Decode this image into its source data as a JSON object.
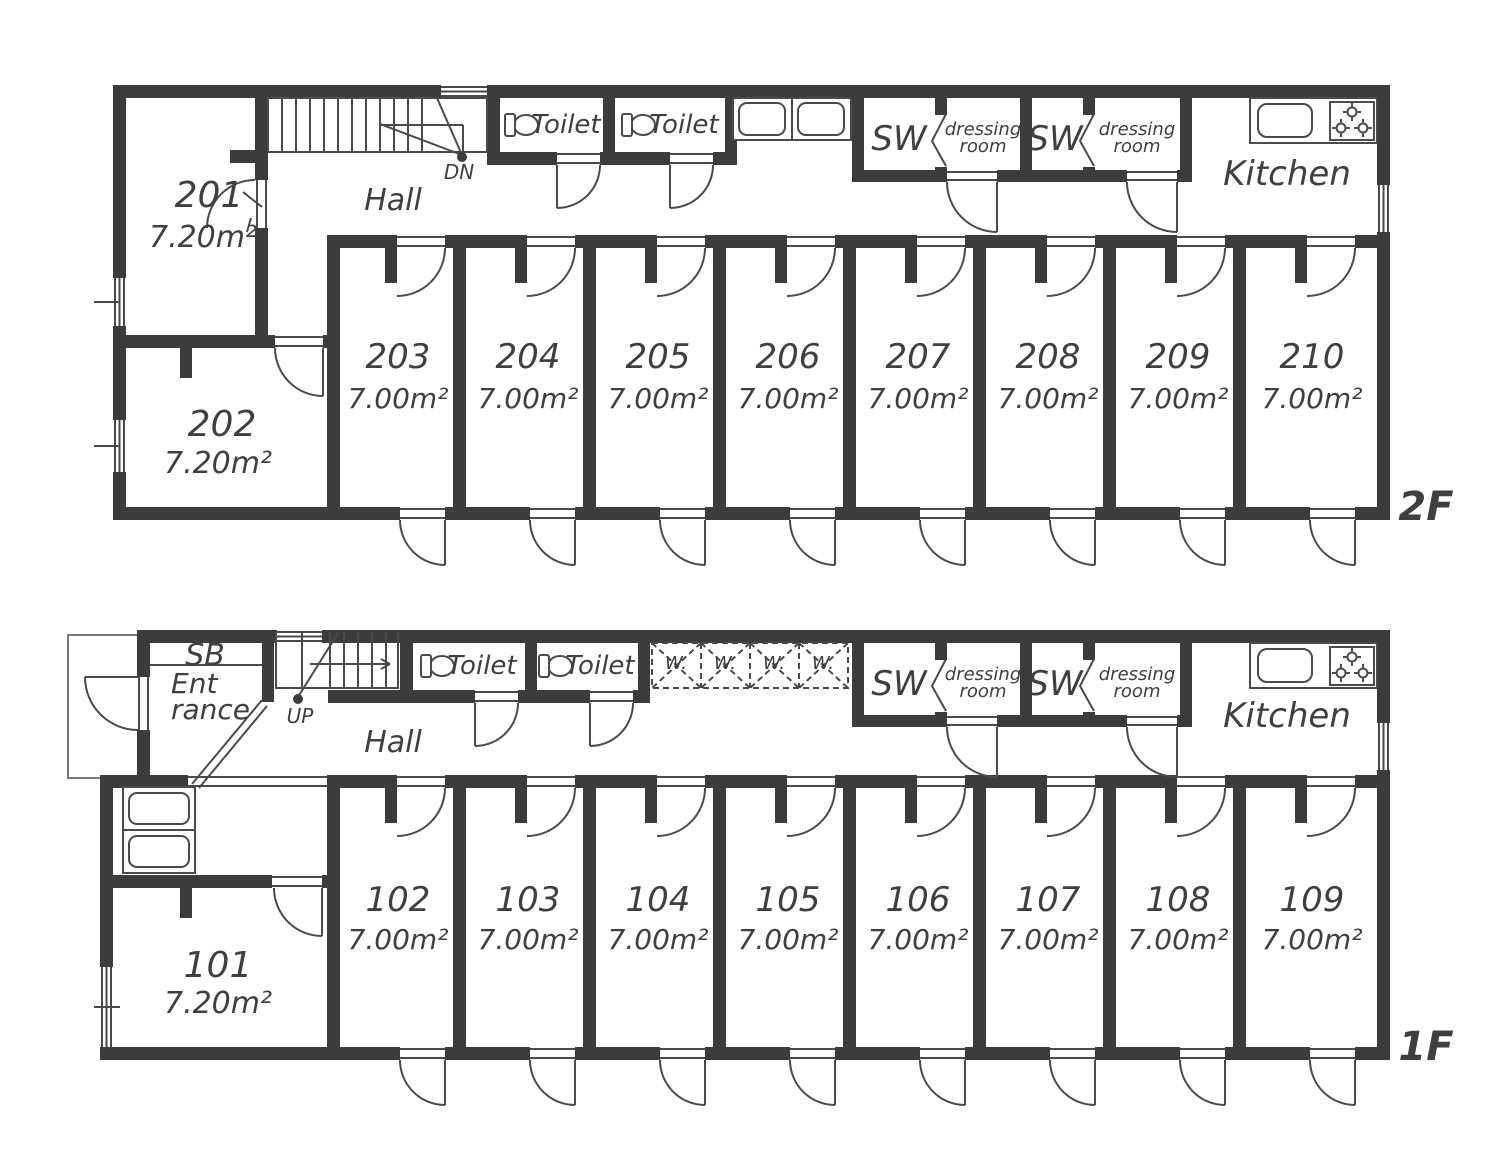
{
  "colors": {
    "wall": "#3c3c3c",
    "line": "#4a4a4a",
    "text": "#3f3f3f"
  },
  "floors": [
    {
      "name": "2F",
      "stair_label": "DN",
      "hall_label": "Hall",
      "toilet_label": "Toilet",
      "sw_label": "SW",
      "dressing_label_line1": "dressing",
      "dressing_label_line2": "room",
      "kitchen_label": "Kitchen",
      "corner_rooms": [
        {
          "number": "201",
          "area": "7.20m²"
        },
        {
          "number": "202",
          "area": "7.20m²"
        }
      ],
      "rooms": [
        {
          "number": "203",
          "area": "7.00m²"
        },
        {
          "number": "204",
          "area": "7.00m²"
        },
        {
          "number": "205",
          "area": "7.00m²"
        },
        {
          "number": "206",
          "area": "7.00m²"
        },
        {
          "number": "207",
          "area": "7.00m²"
        },
        {
          "number": "208",
          "area": "7.00m²"
        },
        {
          "number": "209",
          "area": "7.00m²"
        },
        {
          "number": "210",
          "area": "7.00m²"
        }
      ]
    },
    {
      "name": "1F",
      "stair_label": "UP",
      "hall_label": "Hall",
      "toilet_label": "Toilet",
      "sw_label": "SW",
      "dressing_label_line1": "dressing",
      "dressing_label_line2": "room",
      "kitchen_label": "Kitchen",
      "shoebox_label": "SB",
      "entrance_label_line1": "Ent",
      "entrance_label_line2": "rance",
      "washer_label": "W.",
      "corner_rooms": [
        {
          "number": "101",
          "area": "7.20m²"
        }
      ],
      "rooms": [
        {
          "number": "102",
          "area": "7.00m²"
        },
        {
          "number": "103",
          "area": "7.00m²"
        },
        {
          "number": "104",
          "area": "7.00m²"
        },
        {
          "number": "105",
          "area": "7.00m²"
        },
        {
          "number": "106",
          "area": "7.00m²"
        },
        {
          "number": "107",
          "area": "7.00m²"
        },
        {
          "number": "108",
          "area": "7.00m²"
        },
        {
          "number": "109",
          "area": "7.00m²"
        }
      ]
    }
  ]
}
